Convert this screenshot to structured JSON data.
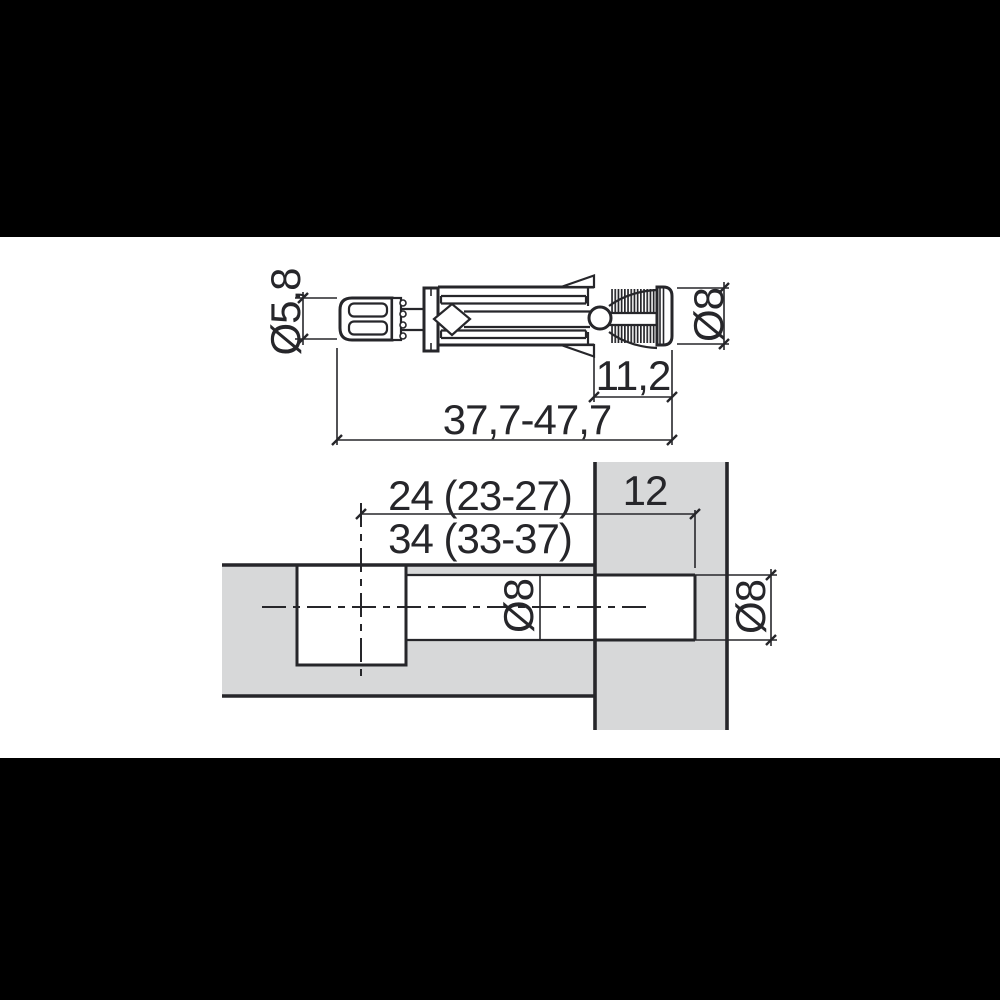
{
  "colors": {
    "background": "#000000",
    "paper": "#ffffff",
    "line": "#26262a",
    "panel_fill": "#d7d8d9"
  },
  "top_view": {
    "labels": {
      "head_diameter": "Ø5,8",
      "sleeve_diameter": "Ø8",
      "thread_section_length": "11,2",
      "overall_length": "37,7-47,7"
    }
  },
  "section_view": {
    "labels": {
      "drilling_depth_a": "24 (23-27)",
      "drilling_depth_b": "34 (33-37)",
      "panel_thickness": "12",
      "bore_diameter": "Ø8",
      "panel_bore_diameter": "Ø8"
    }
  }
}
